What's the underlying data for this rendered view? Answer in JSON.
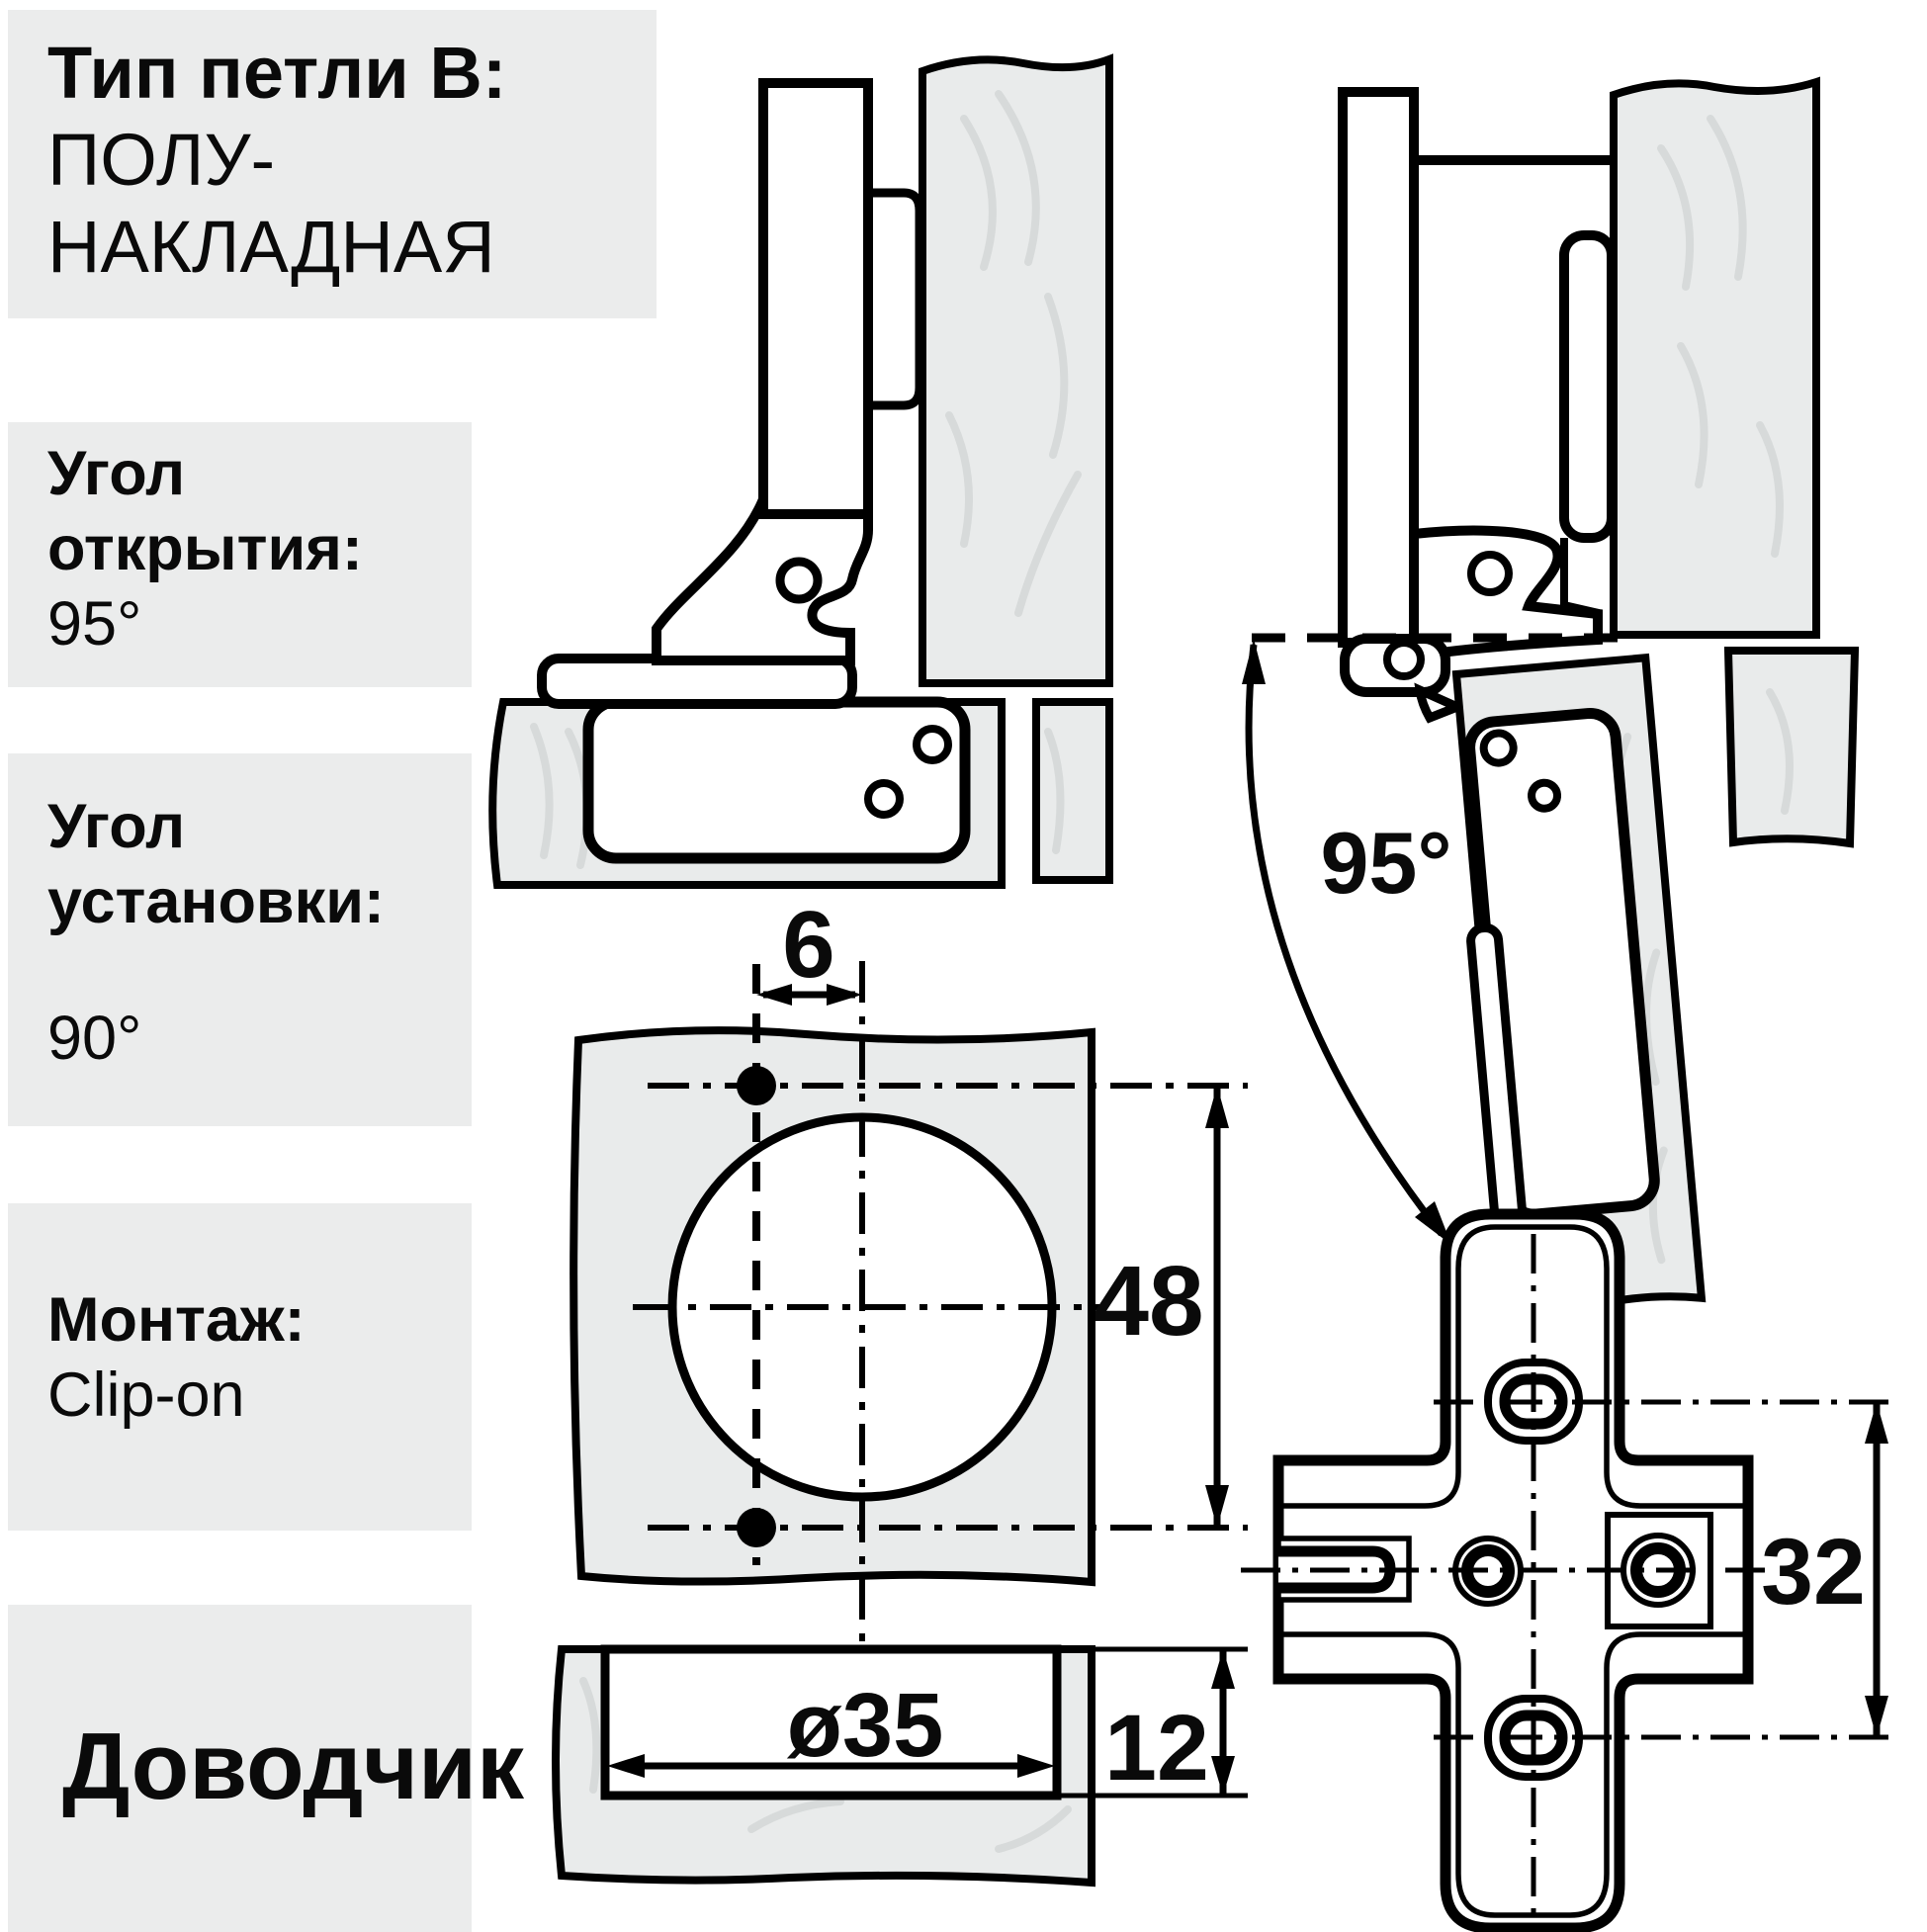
{
  "page": {
    "background": "#ffffff",
    "ink": "#000000",
    "panel_bg": "#ebecec",
    "wood_fill": "#e9ebeb",
    "grain_stroke": "#d7dada"
  },
  "sidebar": {
    "hinge_type": {
      "label": "Тип петли B:",
      "value_line1": "ПОЛУ-",
      "value_line2": "НАКЛАДНАЯ"
    },
    "opening_angle": {
      "label_line1": "Угол",
      "label_line2": "открытия:",
      "value": "95°"
    },
    "mounting_angle": {
      "label_line1": "Угол",
      "label_line2": "установки:",
      "value": "90°"
    },
    "mounting": {
      "label": "Монтаж:",
      "value": "Clip-on"
    },
    "closer": {
      "label": "Доводчик"
    }
  },
  "diagram": {
    "open_angle_label": "95°",
    "dims": {
      "hole_offset": "6",
      "hole_pitch": "48",
      "cup_diameter": "ø35",
      "cup_depth": "12",
      "system_pitch": "32"
    }
  }
}
